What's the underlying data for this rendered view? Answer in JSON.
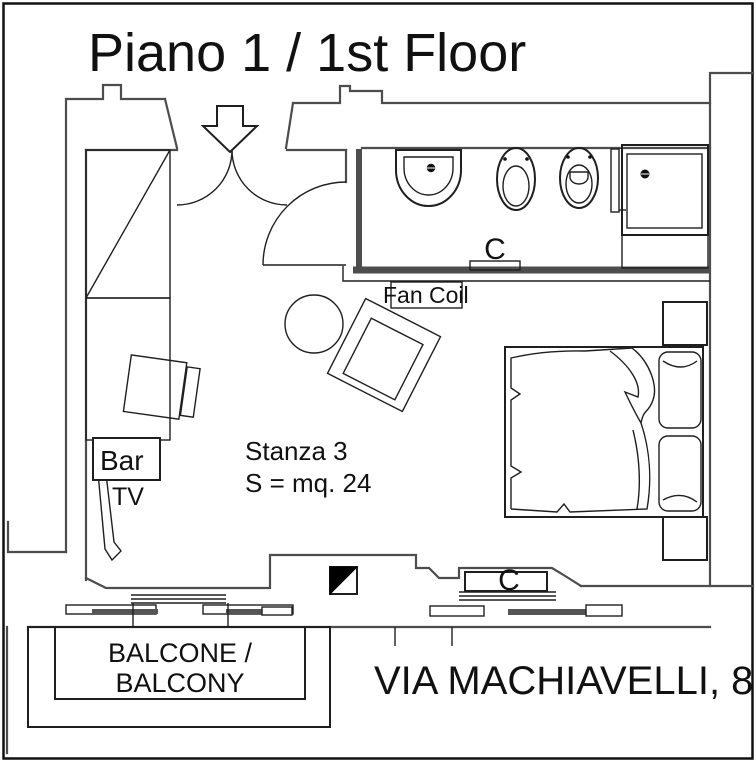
{
  "title": "Piano 1 / 1st Floor",
  "address": "VIA MACHIAVELLI, 8",
  "room": {
    "name": "Stanza 3",
    "area": "S = mq. 24"
  },
  "labels": {
    "fan_coil": "Fan Coil",
    "radiator_top": "C",
    "radiator_bottom": "C",
    "bar": "Bar",
    "tv": "TV"
  },
  "balcony": {
    "line1": "BALCONE /",
    "line2": "BALCONY"
  },
  "colors": {
    "background": "#ffffff",
    "wall": "#4d4d4d",
    "line": "#1f1f1f",
    "marker_fill": "#000000"
  }
}
